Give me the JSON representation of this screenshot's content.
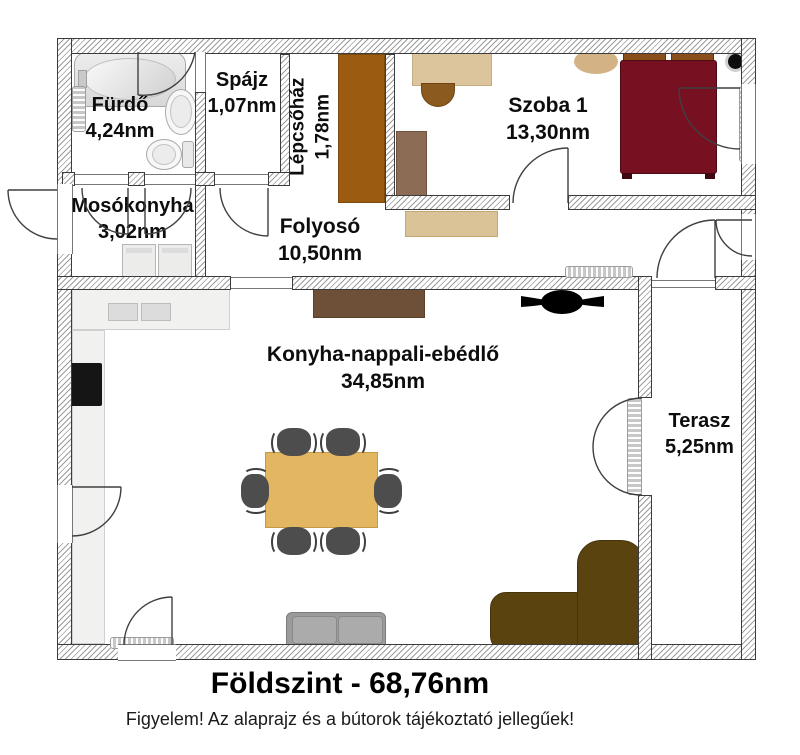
{
  "rooms": {
    "furdo": {
      "name": "Fürdő",
      "area": "4,24nm"
    },
    "spajz": {
      "name": "Spájz",
      "area": "1,07nm"
    },
    "lepcsohaz": {
      "name": "Lépcsőház",
      "area": "1,78nm"
    },
    "szoba1": {
      "name": "Szoba 1",
      "area": "13,30nm"
    },
    "mosokonyha": {
      "name": "Mosókonyha",
      "area": "3,02nm"
    },
    "folyoso": {
      "name": "Folyosó",
      "area": "10,50nm"
    },
    "nappali": {
      "name": "Konyha-nappali-ebédlő",
      "area": "34,85nm"
    },
    "terasz": {
      "name": "Terasz",
      "area": "5,25nm"
    }
  },
  "footer": {
    "title": "Földszint - 68,76nm",
    "disclaimer": "Figyelem! Az alaprajz és a bútorok tájékoztató jellegűek!"
  },
  "colors": {
    "bed": "#771122",
    "pillow": "#8a4e1b",
    "stairs": "#9b5c12",
    "table": "#e3b761",
    "chair": "#4d4d4d",
    "corner_sofa": "#5b430f",
    "sofa": "#9b9b9b",
    "desk": "#dcc49c",
    "desk_chair": "#8a5a1e",
    "rug": "#d3b285",
    "sideboard_hall": "#dbc398",
    "cabinet": "#8d6c55",
    "sideboard_living": "#6e4f38",
    "counter": "#f1f1ef",
    "appliance_black": "#151515"
  }
}
